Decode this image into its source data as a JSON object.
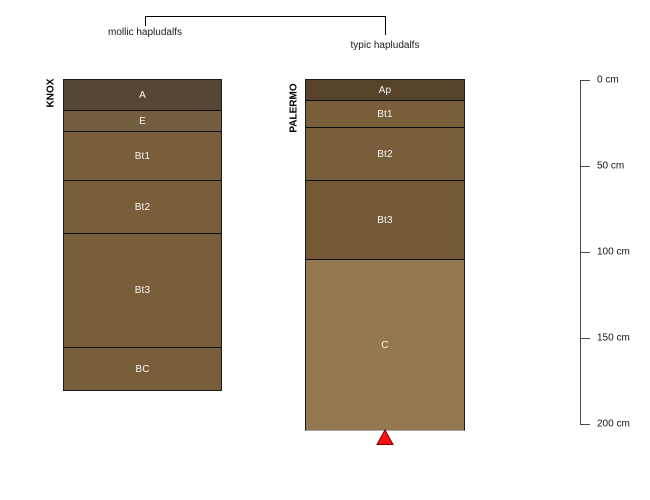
{
  "figure": {
    "background": "#ffffff",
    "bracket": {
      "left_label": "mollic hapludalfs",
      "right_label": "typic hapludalfs"
    },
    "depth_axis": {
      "unit": "cm",
      "tick_labels": [
        "0 cm",
        "50 cm",
        "100 cm",
        "150 cm",
        "200 cm"
      ],
      "tick_values_cm": [
        0,
        50,
        100,
        150,
        200
      ]
    },
    "marker": {
      "shape": "triangle",
      "fill": "#ff0f0f",
      "stroke": "#7a0000",
      "meaning-position": "bottom of PALERMO profile"
    }
  },
  "profiles": [
    {
      "id": "KNOX",
      "classification": "mollic hapludalfs",
      "horizons": [
        {
          "label": "A",
          "top_cm": 0,
          "bottom_cm": 18,
          "color": "#564634"
        },
        {
          "label": "E",
          "top_cm": 18,
          "bottom_cm": 30,
          "color": "#745e41"
        },
        {
          "label": "Bt1",
          "top_cm": 30,
          "bottom_cm": 58,
          "color": "#795e3b"
        },
        {
          "label": "Bt2",
          "top_cm": 58,
          "bottom_cm": 89,
          "color": "#795e3b"
        },
        {
          "label": "Bt3",
          "top_cm": 89,
          "bottom_cm": 156,
          "color": "#795e3b"
        },
        {
          "label": "BC",
          "top_cm": 156,
          "bottom_cm": 181,
          "color": "#795e3b"
        }
      ]
    },
    {
      "id": "PALERMO",
      "classification": "typic hapludalfs",
      "horizons": [
        {
          "label": "Ap",
          "top_cm": 0,
          "bottom_cm": 12,
          "color": "#56432a"
        },
        {
          "label": "Bt1",
          "top_cm": 12,
          "bottom_cm": 27,
          "color": "#795e3b"
        },
        {
          "label": "Bt2",
          "top_cm": 27,
          "bottom_cm": 58,
          "color": "#795e3b"
        },
        {
          "label": "Bt3",
          "top_cm": 58,
          "bottom_cm": 104,
          "color": "#755a38"
        },
        {
          "label": "C",
          "top_cm": 104,
          "bottom_cm": 204,
          "color": "#947950"
        }
      ]
    }
  ],
  "chart_data": {
    "type": "table",
    "title": "Soil profile sketches with taxonomic bracket annotation",
    "ylabel": "depth (cm)",
    "axis_range_cm": [
      0,
      200
    ],
    "categories": [
      "KNOX",
      "PALERMO"
    ],
    "series": [
      {
        "name": "KNOX horizon boundaries (cm)",
        "values": [
          0,
          18,
          30,
          58,
          89,
          156,
          181
        ]
      },
      {
        "name": "PALERMO horizon boundaries (cm)",
        "values": [
          0,
          12,
          27,
          58,
          104,
          204
        ]
      }
    ],
    "annotations": [
      "mollic hapludalfs -> KNOX",
      "typic hapludalfs -> PALERMO",
      "red triangle at PALERMO bottom (204 cm)"
    ]
  }
}
